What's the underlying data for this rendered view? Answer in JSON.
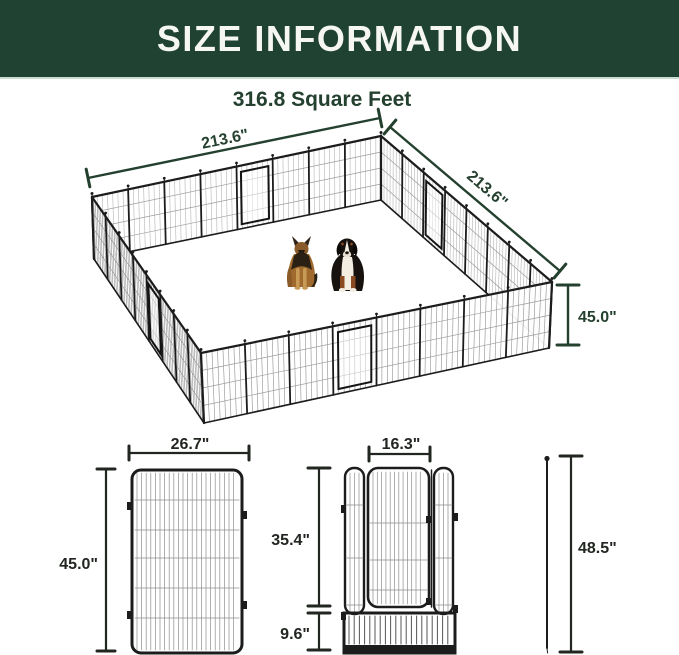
{
  "header": {
    "title": "SIZE INFORMATION",
    "bg_color": "#1f4233",
    "text_color": "#f6f7f3"
  },
  "overview": {
    "area_label": "316.8 Square Feet",
    "width_label": "213.6\"",
    "depth_label": "213.6\"",
    "height_label": "45.0\"",
    "dogs": [
      "german-shepherd-icon",
      "bernese-mountain-dog-icon"
    ]
  },
  "panel_detail": {
    "width_label": "26.7\"",
    "height_label": "45.0\""
  },
  "door_detail": {
    "door_width_label": "16.3\"",
    "door_height_label": "35.4\"",
    "bottom_panel_height_label": "9.6\""
  },
  "stake_detail": {
    "height_label": "48.5\""
  },
  "colors": {
    "accent_green": "#1f4233",
    "dimension_green": "#24402f",
    "dimension_dark": "#222620",
    "fence_black": "#1c1c1c",
    "mesh_gray_back": "#b4b4b4",
    "mesh_gray_front": "#8f8f8f"
  }
}
